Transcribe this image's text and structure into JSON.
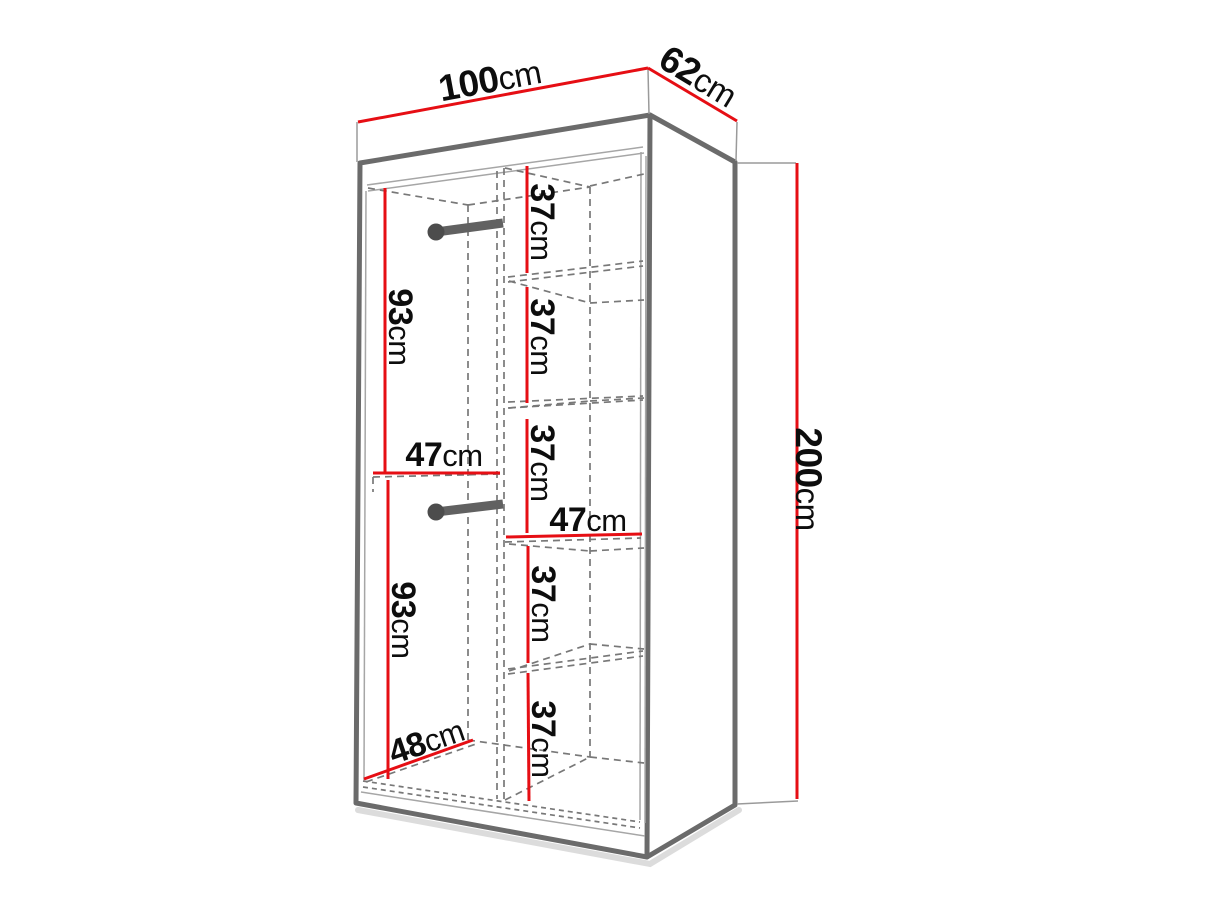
{
  "diagram": {
    "type": "wardrobe-dimension-diagram",
    "colors": {
      "dimension_red": "#e60e14",
      "outline_gray": "#6b6b6b",
      "dashed_gray": "#787878",
      "label_color": "#0d0d0d"
    },
    "dimensions": {
      "width": {
        "value": "100",
        "unit": "cm"
      },
      "depth": {
        "value": "62",
        "unit": "cm"
      },
      "height": {
        "value": "200",
        "unit": "cm"
      },
      "upper_hanging_height": {
        "value": "93",
        "unit": "cm"
      },
      "lower_hanging_height": {
        "value": "93",
        "unit": "cm"
      },
      "left_compartment_width": {
        "value": "47",
        "unit": "cm"
      },
      "right_compartment_width": {
        "value": "47",
        "unit": "cm"
      },
      "interior_depth": {
        "value": "48",
        "unit": "cm"
      },
      "shelf_spacings": [
        {
          "value": "37",
          "unit": "cm"
        },
        {
          "value": "37",
          "unit": "cm"
        },
        {
          "value": "37",
          "unit": "cm"
        },
        {
          "value": "37",
          "unit": "cm"
        },
        {
          "value": "37",
          "unit": "cm"
        }
      ]
    }
  }
}
